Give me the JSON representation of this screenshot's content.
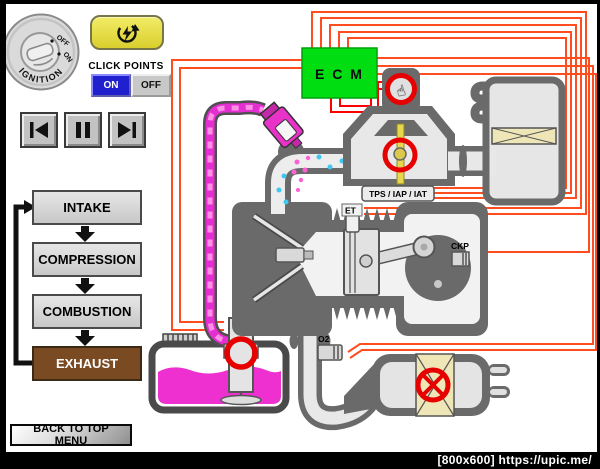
{
  "controls": {
    "ignition": {
      "label": "IGNITION",
      "pos_off": "OFF",
      "pos_on": "ON"
    },
    "click_points": {
      "label": "CLICK POINTS",
      "on_label": "ON",
      "off_label": "OFF"
    }
  },
  "icons": {
    "hand_cursor_glyph": "☝"
  },
  "cycle": {
    "steps": [
      {
        "label": "INTAKE"
      },
      {
        "label": "COMPRESSION"
      },
      {
        "label": "COMBUSTION"
      },
      {
        "label": "EXHAUST"
      }
    ]
  },
  "navigation": {
    "back_label": "BACK TO TOP MENU"
  },
  "diagram": {
    "ecm_label": "E C M",
    "labels": {
      "tps": "TPS / IAP / IAT",
      "et": "ET",
      "ckp": "CKP",
      "o2": "O2"
    }
  },
  "watermark": {
    "text": "[800x600] https://upic.me/"
  },
  "colors": {
    "wire_orange": "#FF4D1F",
    "wire_red": "#FF0000",
    "ecm_green": "#00DD11",
    "click_point_red": "#E60000",
    "fuel_magenta": "#EE30D0",
    "hose_dash_pink": "#FF8FE4",
    "air_cyan": "#3FC8F2",
    "filter_tan": "#EFE6B8",
    "exhaust_step_brown": "#7A4A22",
    "on_button_blue": "#2020CF",
    "start_button_yellow": "#E8DF45"
  }
}
